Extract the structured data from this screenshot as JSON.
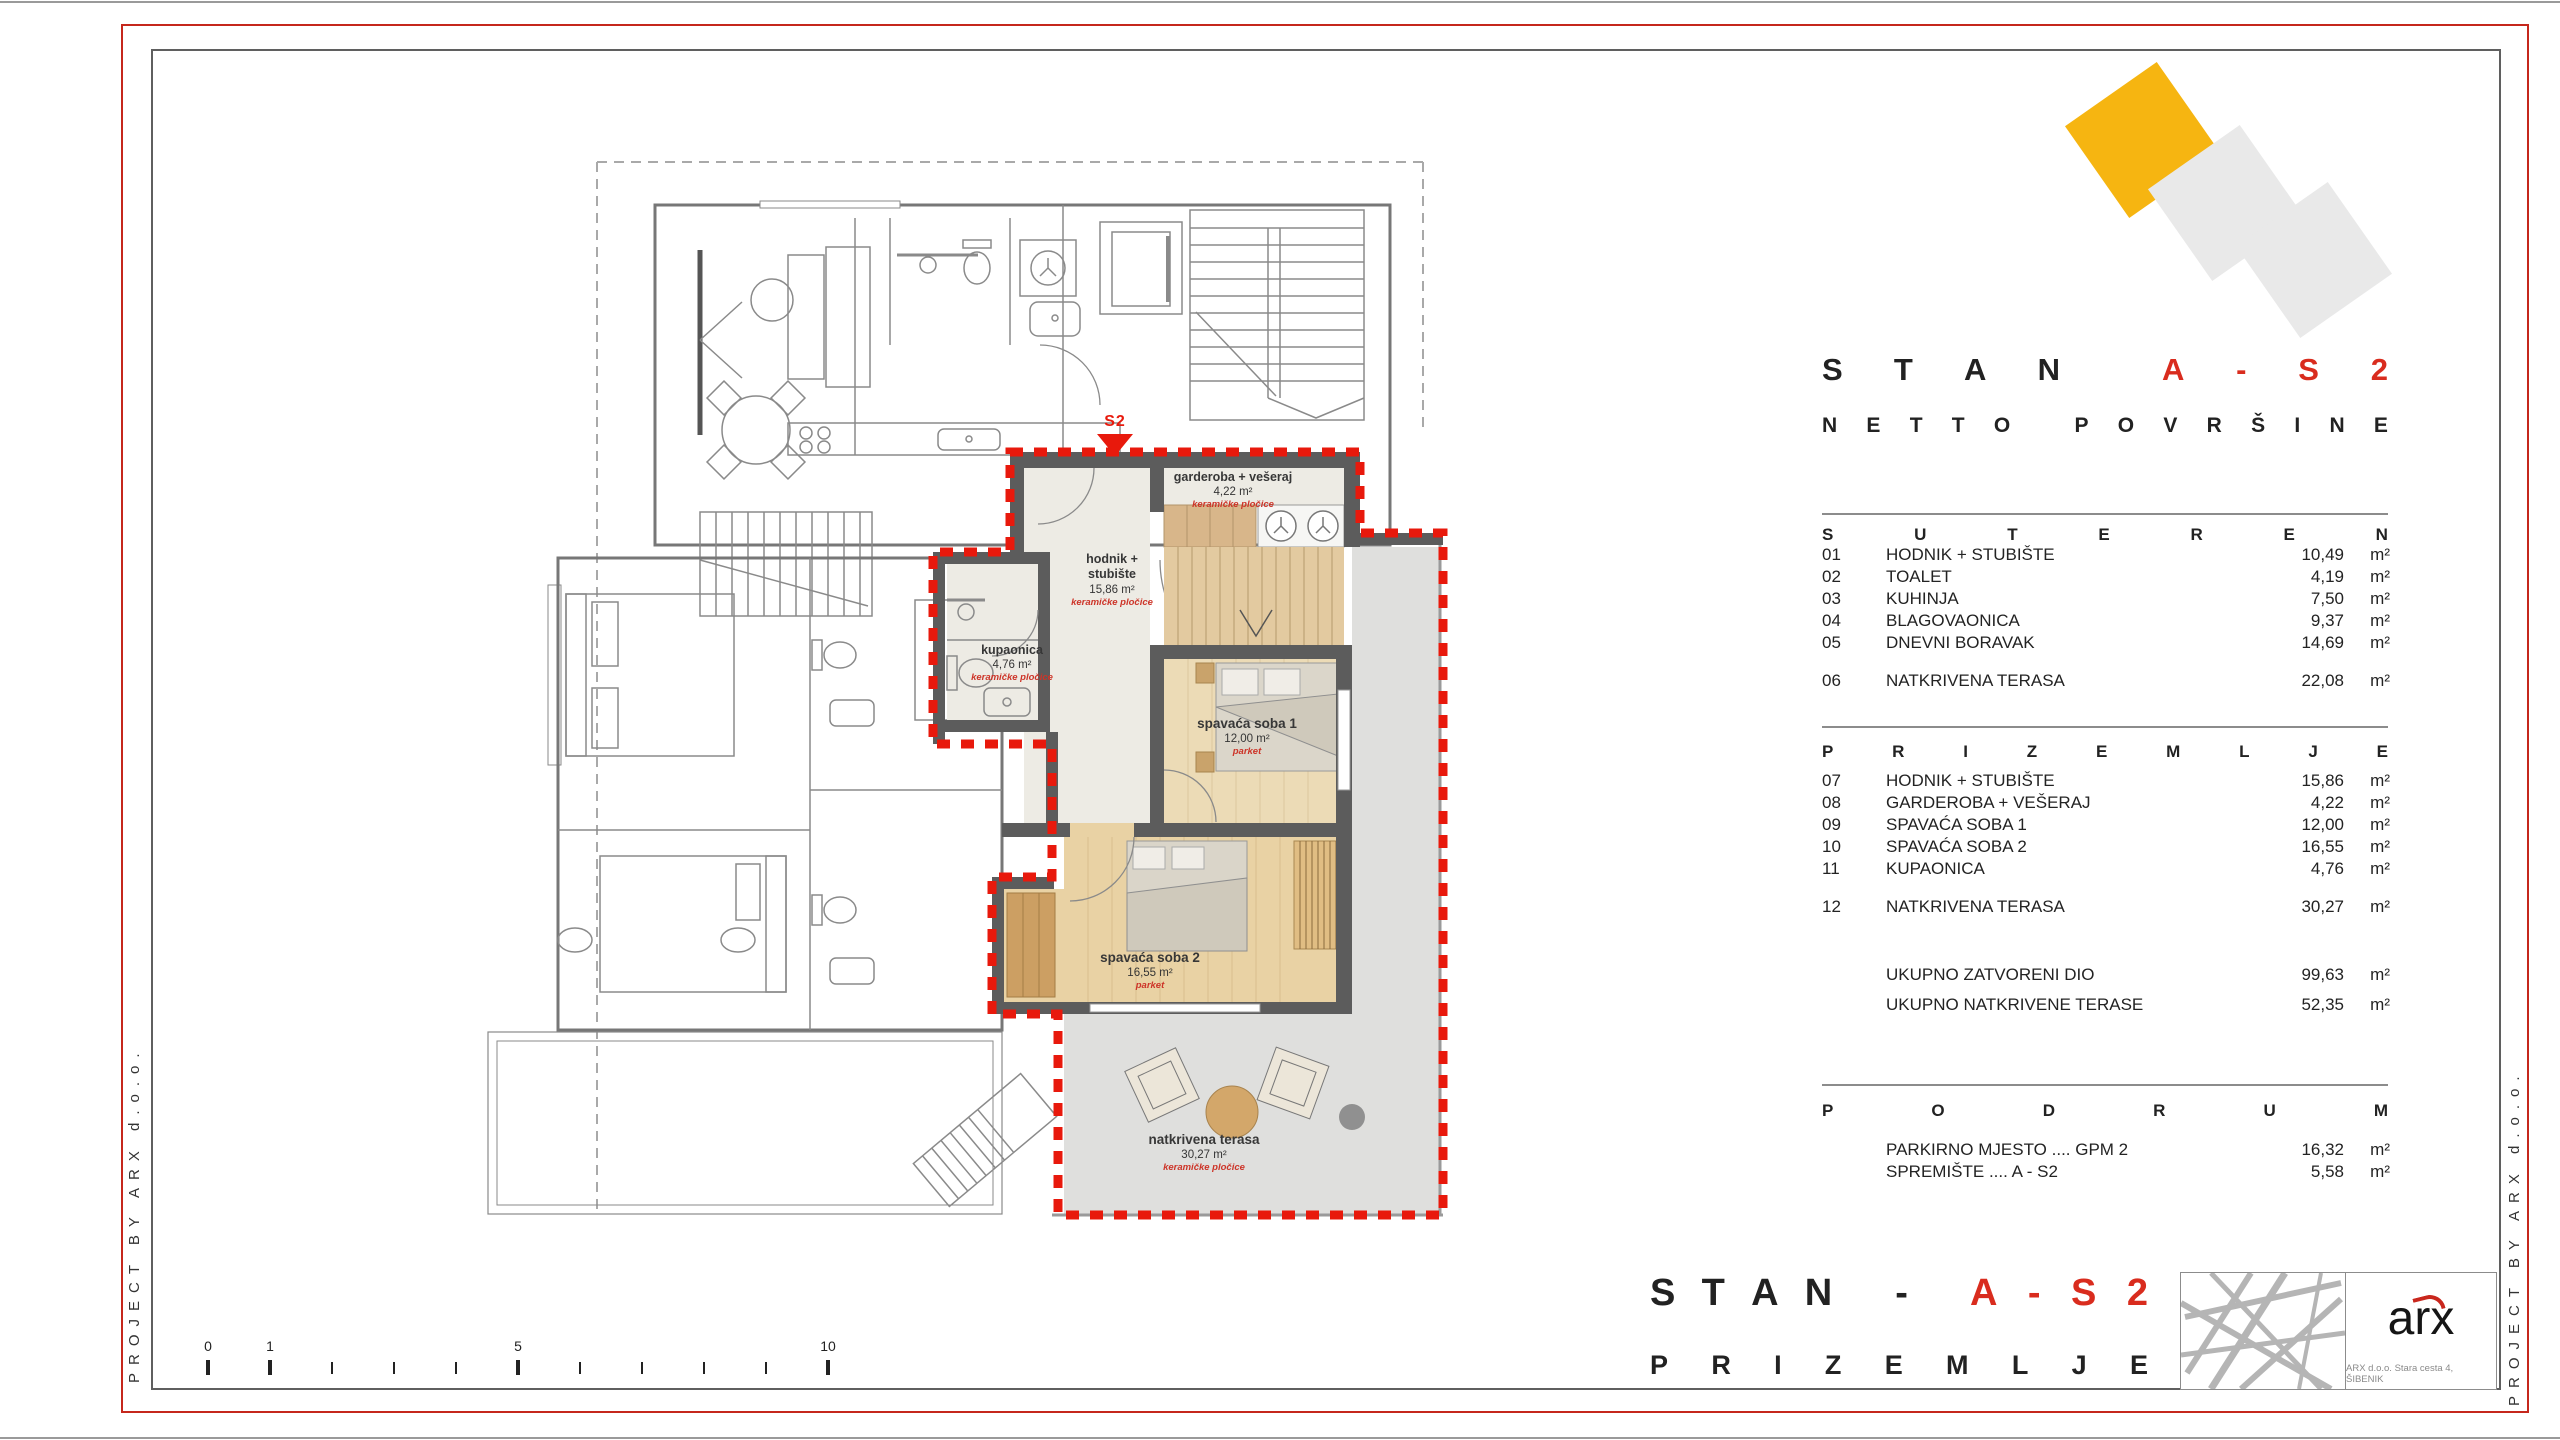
{
  "frame": {
    "side_text": "PROJECT BY ARX d.o.o."
  },
  "colors": {
    "accent_red": "#d92c1e",
    "boundary_red": "#e8190c",
    "logo_yellow": "#f6b511",
    "logo_gray": "#e9e9e9",
    "wall_gray": "#5c5c5c"
  },
  "panel": {
    "title_black": "STAN",
    "title_red": "A-S2",
    "subtitle": "NETTO POVRŠINE",
    "suteren": {
      "heading": "SUTEREN",
      "rows": [
        {
          "num": "01",
          "label": "HODNIK + STUBIŠTE",
          "value": "10,49",
          "unit": "m²"
        },
        {
          "num": "02",
          "label": "TOALET",
          "value": "4,19",
          "unit": "m²"
        },
        {
          "num": "03",
          "label": "KUHINJA",
          "value": "7,50",
          "unit": "m²"
        },
        {
          "num": "04",
          "label": "BLAGOVAONICA",
          "value": "9,37",
          "unit": "m²"
        },
        {
          "num": "05",
          "label": "DNEVNI BORAVAK",
          "value": "14,69",
          "unit": "m²"
        }
      ],
      "terrace_row": {
        "num": "06",
        "label": "NATKRIVENA TERASA",
        "value": "22,08",
        "unit": "m²"
      }
    },
    "prizemlje": {
      "heading": "PRIZEMLJE",
      "rows": [
        {
          "num": "07",
          "label": "HODNIK + STUBIŠTE",
          "value": "15,86",
          "unit": "m²"
        },
        {
          "num": "08",
          "label": "GARDEROBA + VEŠERAJ",
          "value": "4,22",
          "unit": "m²"
        },
        {
          "num": "09",
          "label": "SPAVAĆA SOBA 1",
          "value": "12,00",
          "unit": "m²"
        },
        {
          "num": "10",
          "label": "SPAVAĆA SOBA 2",
          "value": "16,55",
          "unit": "m²"
        },
        {
          "num": "11",
          "label": "KUPAONICA",
          "value": "4,76",
          "unit": "m²"
        }
      ],
      "terrace_row": {
        "num": "12",
        "label": "NATKRIVENA TERASA",
        "value": "30,27",
        "unit": "m²"
      },
      "totals": [
        {
          "label": "UKUPNO ZATVORENI DIO",
          "value": "99,63",
          "unit": "m²"
        },
        {
          "label": "UKUPNO NATKRIVENE TERASE",
          "value": "52,35",
          "unit": "m²"
        }
      ]
    },
    "podrum": {
      "heading": "PODRUM",
      "rows": [
        {
          "label": "PARKIRNO MJESTO .... GPM 2",
          "value": "16,32",
          "unit": "m²"
        },
        {
          "label": "SPREMIŠTE .... A - S2",
          "value": "5,58",
          "unit": "m²"
        }
      ]
    }
  },
  "plan": {
    "marker": "S2",
    "rooms": {
      "garderoba": {
        "name": "garderoba + vešeraj",
        "area": "4,22 m²",
        "note": "keramičke pločice"
      },
      "hodnik": {
        "name": "hodnik + stubište",
        "area": "15,86 m²",
        "note": "keramičke pločice"
      },
      "kupaonica": {
        "name": "kupaonica",
        "area": "4,76 m²",
        "note": "keramičke pločice"
      },
      "spavaca1": {
        "name": "spavaća soba 1",
        "area": "12,00 m²",
        "note": "parket"
      },
      "spavaca2": {
        "name": "spavaća soba 2",
        "area": "16,55 m²",
        "note": "parket"
      },
      "terasa": {
        "name": "natkrivena terasa",
        "area": "30,27 m²",
        "note": "keramičke pločice"
      }
    }
  },
  "scale": {
    "labels": [
      "0",
      "1",
      "5",
      "10"
    ]
  },
  "footer": {
    "title_black": "STAN -",
    "title_red": "A-S2",
    "subtitle": "PRIZEMLJE",
    "logo_text": "arx",
    "address": "ARX d.o.o. Stara cesta 4, ŠIBENIK"
  }
}
